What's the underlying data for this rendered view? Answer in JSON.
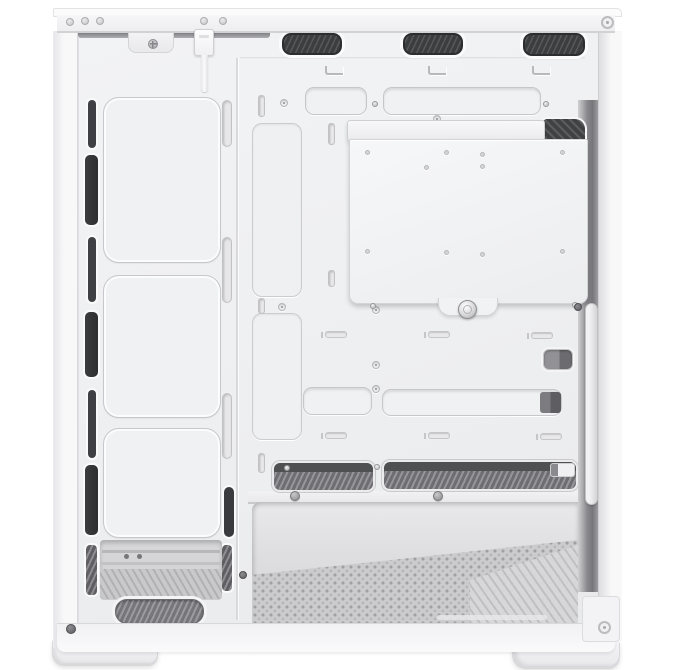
{
  "meta": {
    "subject": "White mid-tower PC case, side panel removed, interior side view product photo",
    "width": 699,
    "height": 670
  },
  "colors": {
    "background": "#ffffff",
    "shell_white": "#f6f6f8",
    "tray_gray": "#eeeff1",
    "groove_line": "#c8c8cc",
    "vent_dark": "#3b3d3f",
    "mesh_gray": "#8a8a8e",
    "bay_interior": "#dedee1",
    "floor_perforated": "#cbcbce",
    "rear_gap_shadow": "#77777b"
  },
  "components": {
    "top_vent_count": 3,
    "front_fan_mount_count": 3,
    "front_slot_count": 7,
    "feet_count": 2,
    "cable_cutout_count": 4,
    "shroud_mesh_opening_count": 2,
    "has_thumbscrew_plate": true,
    "has_front_panel_cable": true
  },
  "names": {
    "rivets": "top-rail-rivet",
    "top_vents": "top-vent-grille",
    "l_marks": "fan-alignment-mark",
    "cable_cutouts": "cable-routing-cutout",
    "cutout_screws": "grommet-screw",
    "tie_slots": "cable-tie-slot",
    "front_slots_thin": "front-airflow-slot-thin",
    "front_slots_wide": "front-airflow-slot-wide",
    "front_slots_hatch": "front-airflow-slot-mesh",
    "side_pills": "fan-mount-slot",
    "side_slot_dark": "fan-mount-slot-dark",
    "fan_squares": "front-fan-mount-outline",
    "bracket_slots": "tray-bracket-slot",
    "tall_grooves": "cable-channel-groove",
    "dark_cutouts": "rear-cable-cutout",
    "dark_inserts": "rear-cable-cutout-insert",
    "mesh_openings": "shroud-mesh-opening",
    "mesh_caps": "shroud-opening-endcap",
    "standoffs": "motherboard-standoff",
    "plate_holes": "mounting-plate-hole",
    "plate_screws": "mounting-plate-screw",
    "mesh_screws": "shroud-screw",
    "rail_screws": "shroud-rail-screw",
    "misc_screws_dark": "frame-screw"
  },
  "shapes": {
    "rivets": [
      {
        "x": 66,
        "y": 18
      },
      {
        "x": 81,
        "y": 17
      },
      {
        "x": 96,
        "y": 17
      },
      {
        "x": 200,
        "y": 17
      },
      {
        "x": 219,
        "y": 17
      }
    ],
    "top_vents": [
      {
        "x": 282,
        "y": 33,
        "w": 60,
        "h": 22
      },
      {
        "x": 403,
        "y": 33,
        "w": 60,
        "h": 22
      },
      {
        "x": 523,
        "y": 33,
        "w": 62,
        "h": 23
      }
    ],
    "l_marks": [
      {
        "x": 325,
        "y": 66,
        "w": 18,
        "h": 9
      },
      {
        "x": 428,
        "y": 66,
        "w": 18,
        "h": 9
      },
      {
        "x": 532,
        "y": 66,
        "w": 18,
        "h": 9
      }
    ],
    "cable_cutouts": [
      {
        "x": 305,
        "y": 87,
        "w": 62,
        "h": 28
      },
      {
        "x": 383,
        "y": 87,
        "w": 158,
        "h": 28
      },
      {
        "x": 303,
        "y": 387,
        "w": 69,
        "h": 28
      },
      {
        "x": 382,
        "y": 389,
        "w": 180,
        "h": 27
      }
    ],
    "cutout_screws": [
      {
        "x": 372,
        "y": 101
      },
      {
        "x": 543,
        "y": 101
      }
    ],
    "tie_slots": [
      {
        "x": 325,
        "y": 331
      },
      {
        "x": 428,
        "y": 331
      },
      {
        "x": 531,
        "y": 332
      },
      {
        "x": 325,
        "y": 432
      },
      {
        "x": 428,
        "y": 432
      },
      {
        "x": 540,
        "y": 433
      }
    ],
    "front_slots_thin": [
      {
        "x": 88,
        "y": 100,
        "w": 8,
        "h": 48
      },
      {
        "x": 88,
        "y": 237,
        "w": 8,
        "h": 65
      },
      {
        "x": 88,
        "y": 390,
        "w": 8,
        "h": 68
      }
    ],
    "front_slots_wide": [
      {
        "x": 85,
        "y": 155,
        "w": 13,
        "h": 70
      },
      {
        "x": 85,
        "y": 312,
        "w": 13,
        "h": 65
      },
      {
        "x": 85,
        "y": 465,
        "w": 13,
        "h": 70
      }
    ],
    "front_slots_hatch": [
      {
        "x": 86,
        "y": 545,
        "w": 11,
        "h": 50
      },
      {
        "x": 222,
        "y": 545,
        "w": 10,
        "h": 46
      }
    ],
    "side_pills": [
      {
        "x": 222,
        "y": 100,
        "w": 10,
        "h": 47
      },
      {
        "x": 222,
        "y": 237,
        "w": 10,
        "h": 66
      },
      {
        "x": 222,
        "y": 393,
        "w": 10,
        "h": 66
      }
    ],
    "side_slot_dark": [
      {
        "x": 224,
        "y": 487,
        "w": 10,
        "h": 50
      }
    ],
    "fan_squares": [
      {
        "x": 103,
        "y": 97,
        "w": 118,
        "h": 166
      },
      {
        "x": 103,
        "y": 275,
        "w": 118,
        "h": 143
      },
      {
        "x": 103,
        "y": 428,
        "w": 118,
        "h": 110
      }
    ],
    "bracket_slots": [
      {
        "x": 258,
        "y": 95,
        "w": 7,
        "h": 22
      },
      {
        "x": 328,
        "y": 123,
        "w": 7,
        "h": 22
      },
      {
        "x": 258,
        "y": 298,
        "w": 7,
        "h": 16
      },
      {
        "x": 328,
        "y": 270,
        "w": 7,
        "h": 17
      },
      {
        "x": 258,
        "y": 453,
        "w": 7,
        "h": 20
      }
    ],
    "tall_grooves": [
      {
        "x": 252,
        "y": 123,
        "w": 50,
        "h": 174
      },
      {
        "x": 252,
        "y": 313,
        "w": 50,
        "h": 127
      }
    ],
    "dark_cutouts": [
      {
        "x": 543,
        "y": 349,
        "w": 30,
        "h": 21
      }
    ],
    "dark_inserts": [
      {
        "x": 540,
        "y": 392,
        "w": 21,
        "h": 21
      }
    ],
    "mesh_openings": [
      {
        "x": 272,
        "y": 461,
        "w": 103,
        "h": 31
      },
      {
        "x": 382,
        "y": 460,
        "w": 196,
        "h": 31
      }
    ],
    "mesh_caps": [
      {
        "x": 550,
        "y": 463,
        "w": 25,
        "h": 14
      }
    ],
    "standoffs": [
      {
        "x": 280,
        "y": 99
      },
      {
        "x": 433,
        "y": 115
      },
      {
        "x": 278,
        "y": 303
      },
      {
        "x": 372,
        "y": 306
      },
      {
        "x": 424,
        "y": 276
      },
      {
        "x": 481,
        "y": 288
      },
      {
        "x": 372,
        "y": 361
      },
      {
        "x": 372,
        "y": 385
      }
    ],
    "plate_holes": [
      {
        "x": 365,
        "y": 150
      },
      {
        "x": 444,
        "y": 150
      },
      {
        "x": 480,
        "y": 152
      },
      {
        "x": 560,
        "y": 150
      },
      {
        "x": 424,
        "y": 165
      },
      {
        "x": 480,
        "y": 164
      },
      {
        "x": 365,
        "y": 249
      },
      {
        "x": 444,
        "y": 250
      },
      {
        "x": 480,
        "y": 252
      },
      {
        "x": 560,
        "y": 249
      }
    ],
    "plate_screws": [
      {
        "x": 370,
        "y": 303
      },
      {
        "x": 572,
        "y": 302
      }
    ],
    "mesh_screws": [
      {
        "x": 284,
        "y": 465
      },
      {
        "x": 374,
        "y": 464
      }
    ],
    "rail_screws": [
      {
        "x": 290,
        "y": 491
      },
      {
        "x": 433,
        "y": 491
      }
    ],
    "misc_screws_dark": [
      {
        "x": 239,
        "y": 571,
        "w": 8,
        "h": 8
      },
      {
        "x": 574,
        "y": 303,
        "w": 8,
        "h": 8
      },
      {
        "x": 66,
        "y": 624,
        "w": 10,
        "h": 10
      }
    ]
  }
}
